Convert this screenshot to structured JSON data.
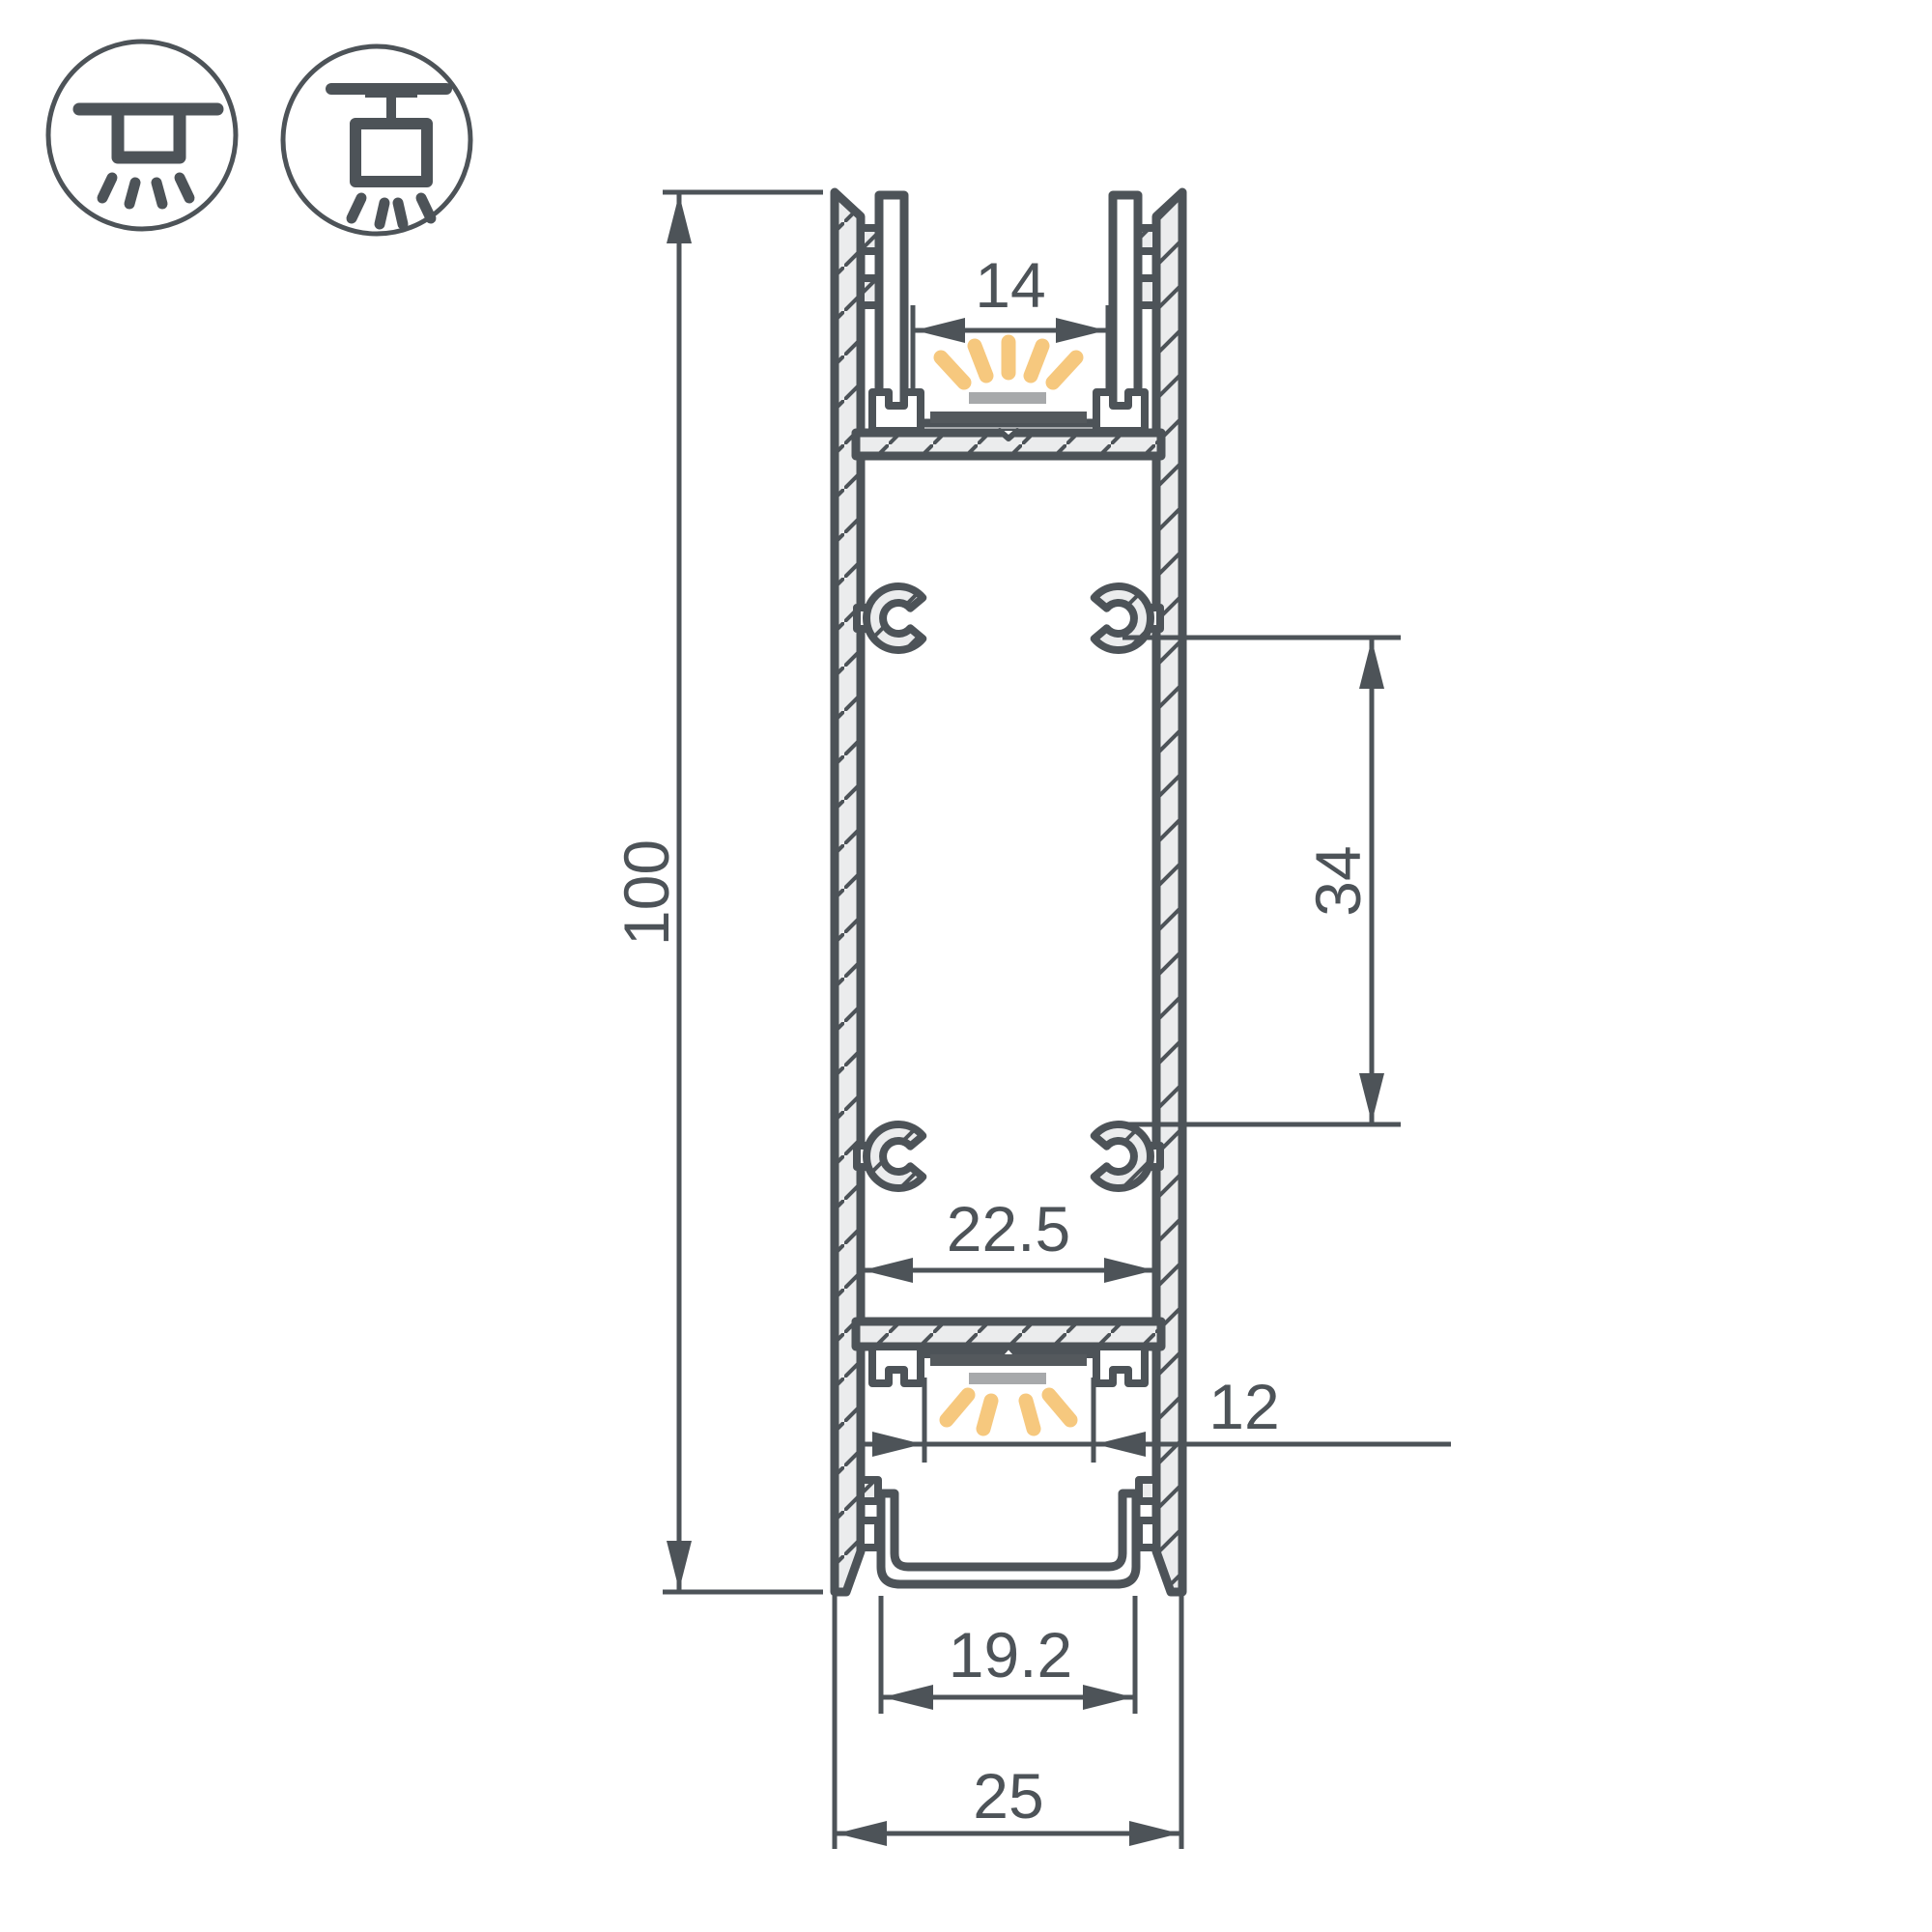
{
  "page": {
    "background": "#ffffff"
  },
  "colors": {
    "line": "#4d5358",
    "hatch_fill": "#ebeced",
    "glow": "#f6c87e",
    "diffuser_gray": "#a7a9ab",
    "pcb_dark": "#54595d",
    "white": "#ffffff"
  },
  "icons": [
    {
      "name": "ceiling-surface-mount-icon"
    },
    {
      "name": "ceiling-pendant-mount-icon"
    }
  ],
  "dimensions": {
    "total_height": "100",
    "top_channel_opening": "14",
    "boss_spacing": "34",
    "inner_width": "22.5",
    "bottom_aperture": "12",
    "bottom_opening": "19.2",
    "total_width": "25"
  }
}
